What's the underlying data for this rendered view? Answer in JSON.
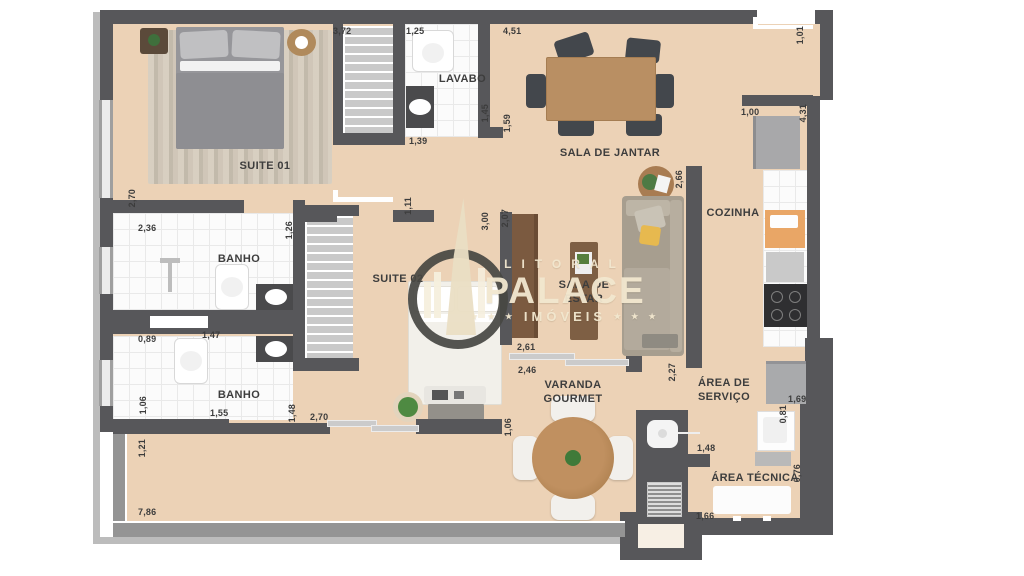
{
  "plan_title": "apartment-floor-plan",
  "brand": {
    "line1": "LITORAL",
    "line2": "PALACE",
    "line3": "IMÓVEIS",
    "stars_left": "★ ★ ★",
    "stars_right": "★ ★ ★"
  },
  "rooms": {
    "suite01": "SUITE 01",
    "lavabo": "LAVABO",
    "sala_jantar": "SALA DE JANTAR",
    "banho1": "BANHO",
    "suite02": "SUITE 02",
    "sala_estar": "SALA DE ESTAR",
    "cozinha": "COZINHA",
    "banho2": "BANHO",
    "varanda": "VARANDA GOURMET",
    "area_servico": "ÁREA DE SERVIÇO",
    "area_tecnica": "ÁREA TÉCNICA"
  },
  "dims": [
    "3,72",
    "1,25",
    "4,51",
    "1,01",
    "1,39",
    "1,45",
    "1,59",
    "2,70",
    "2,36",
    "1,26",
    "1,11",
    "3,00",
    "2,07",
    "2,66",
    "1,00",
    "4,31",
    "0,89",
    "1,47",
    "1,06",
    "1,55",
    "1,48",
    "2,70",
    "1,21",
    "7,86",
    "2,61",
    "2,46",
    "1,06",
    "2,27",
    "1,69",
    "0,81",
    "1,48",
    "0,76",
    "1,66"
  ],
  "colors": {
    "wall": "#57575a",
    "floor": "#ecd2b6",
    "tile": "#fbfbfb",
    "wood": "#b8916b",
    "watermark": "#f2e8d0"
  }
}
